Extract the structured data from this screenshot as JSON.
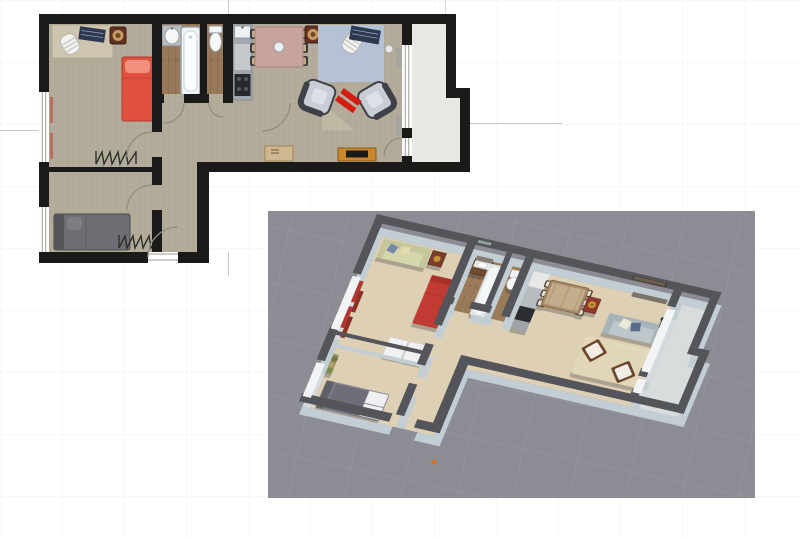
{
  "page": {
    "background": "#ffffff"
  },
  "views": {
    "plan_2d": {
      "label": "2d-floor-plan",
      "rooms": [
        "bedroom-top-left",
        "bathroom",
        "wc",
        "kitchen",
        "living-dining-room",
        "hallway",
        "bedroom-bottom-left",
        "entry-corridor",
        "balcony"
      ],
      "furniture": [
        "desk",
        "office-chair",
        "laptop",
        "plant-pot",
        "single-bed-red",
        "radiator",
        "window-curtain",
        "washbasin",
        "bathtub",
        "toilet",
        "kitchen-counter",
        "kitchen-sink",
        "stove",
        "dining-table",
        "dining-chairs-x6",
        "serving-bowl",
        "plant-pot-2",
        "blue-rug",
        "office-chair-2",
        "laptop-2",
        "armchair-left",
        "armchair-right",
        "red-coffee-table",
        "carpet-triangle",
        "sideboard",
        "tv-lowboard",
        "tv",
        "double-bed-gray",
        "radiator-2",
        "door-swing-arcs",
        "window-x4"
      ]
    },
    "view_3d": {
      "label": "3d-dollhouse-view",
      "background": "#8c8d94",
      "furniture": [
        "beige-sofa",
        "throw-pillows",
        "nightstand",
        "table-lamp",
        "single-bed-red",
        "white-mattresses",
        "red-curtains",
        "double-bed-gray",
        "foot-mats",
        "coat-stand-plant",
        "vanity-unit",
        "wall-mirror",
        "bathtub",
        "toilet",
        "kitchen-units",
        "dining-table",
        "dining-chairs-x6",
        "red-cabinet",
        "brass-lamp",
        "wall-picture",
        "gray-sofa",
        "sofa-pillows",
        "area-rug",
        "wooden-chair-1",
        "wooden-chair-2",
        "floor-lamp",
        "camera-marker"
      ]
    }
  },
  "colors": {
    "wall_2d": "#1a1a18",
    "window": "#fdfdfc",
    "frame": "#a0a09a",
    "floor": "#b3ab99",
    "floor_light": "#cdc5ae",
    "wood": "#97795a",
    "wood_dark": "#7c6147",
    "balcony": "#e8e8e5",
    "arc": "#8e8e84",
    "guide": "#c9c9c4",
    "red": "#e2503f",
    "red_deep": "#c23b33",
    "red_bright": "#d41c12",
    "blue_rug": "#b5c1d4",
    "keyboard": "#2e3850",
    "counter": "#a2a8af",
    "stove": "#26282b",
    "table": "#c7a49b",
    "chair_dark": "#3a3c41",
    "tan": "#c3ab84",
    "silver": "#c9cdd6",
    "bed_gray": "#6e6f74",
    "tv_wood": "#c9882f",
    "panel": "#8c8d94",
    "wall_top": "#54555b",
    "wall_face": "#c3ced4",
    "floor3d": "#ddd0b4",
    "wood3d": "#9b7c5a",
    "balcony3d": "#d9dcdd",
    "slab_face": "#d6dadc",
    "slab_white": "#f2f4f5",
    "sofa3d": "#d6d6ac",
    "sofa_gray": "#bcc6cb",
    "rug3d": "#e4d9ba",
    "table3d": "#a98a68",
    "orange": "#cd7129"
  }
}
